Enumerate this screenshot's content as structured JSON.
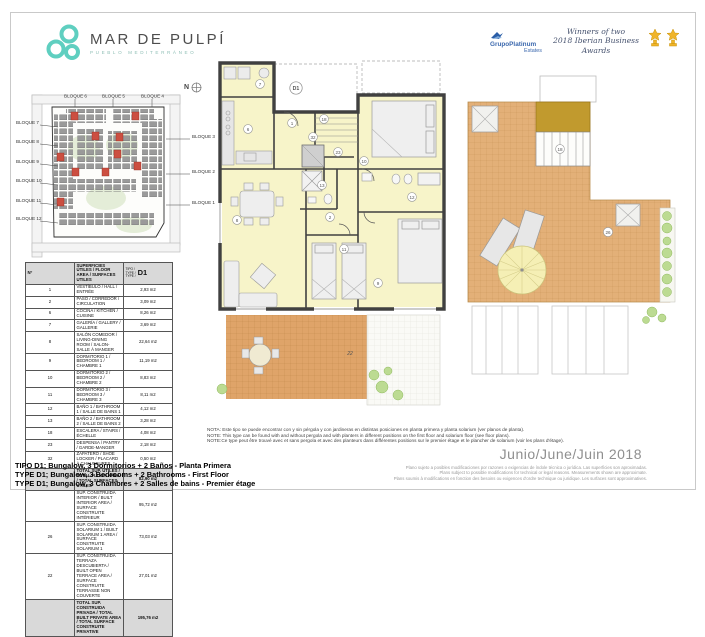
{
  "header": {
    "logo": {
      "title": "MAR DE PULPÍ",
      "subtitle": "PUEBLO MEDITERRÁNEO"
    },
    "awards": {
      "brand_top": "GrupoPlatinum",
      "brand_bottom": "Estates",
      "script_line1": "Winners of two",
      "script_line2": "2018 Iberian Business Awards"
    }
  },
  "site_plan": {
    "north_label": "N",
    "labels_top": [
      "BLOQUE 6",
      "BLOQUE 5",
      "BLOQUE 4"
    ],
    "labels_left": [
      "BLOQUE 7",
      "BLOQUE 8",
      "BLOQUE 9",
      "BLOQUE 10",
      "BLOQUE 11",
      "BLOQUE 12"
    ],
    "labels_right": [
      "BLOQUE 3",
      "BLOQUE 2",
      "BLOQUE 1"
    ]
  },
  "main_plan": {
    "unit_label": "D1",
    "room_numbers": {
      "vestibulo": "1",
      "paso": "2",
      "cocina": "6",
      "galeria": "7",
      "salon": "8",
      "dormitorio1": "9",
      "dormitorio2": "10",
      "dormitorio3": "11",
      "bano1": "12",
      "bano2": "13",
      "escalera": "18",
      "despensa": "23",
      "zapatero": "32",
      "terraza": "22"
    }
  },
  "solarium_plan": {
    "room_numbers": {
      "solarium": "26",
      "escalera": "18"
    }
  },
  "area_table": {
    "header": {
      "num": "Nº",
      "desc": "SUPERFICIES ÚTILES / FLOOR AREA / SURFACES UTILES",
      "type_stack": "TIPO /\nTYPE /\nTYPE /",
      "model": "D1"
    },
    "rows": [
      {
        "num": "1",
        "desc": "VESTÍBULO / HALL / ENTRÉE",
        "value": "2,93 m2"
      },
      {
        "num": "2",
        "desc": "PASO / CORREDOR / CIRCULATION",
        "value": "3,09 m2"
      },
      {
        "num": "6",
        "desc": "COCINA / KITCHEN / CUISINE",
        "value": "8,26 m2"
      },
      {
        "num": "7",
        "desc": "GALERÍA / GALLERY / GALLERIE",
        "value": "3,69 m2"
      },
      {
        "num": "8",
        "desc": "SALÓN COMEDOR / LIVING-DINING ROOM / SALON-SALLE À MANGER",
        "value": "22,64 m2"
      },
      {
        "num": "9",
        "desc": "DORMITORIO 1 / BEDROOM 1 / CHAMBRE 1",
        "value": "11,19 m2"
      },
      {
        "num": "10",
        "desc": "DORMITORIO 2 / BEDROOM 2 / CHAMBRE 2",
        "value": "8,83 m2"
      },
      {
        "num": "11",
        "desc": "DORMITORIO 3 / BEDROOM 3 / CHAMBRE 3",
        "value": "8,11 m2"
      },
      {
        "num": "12",
        "desc": "BAÑO 1 / BATHROOM 1 / SALLE DE BAINS 1",
        "value": "4,12 m2"
      },
      {
        "num": "13",
        "desc": "BAÑO 2 / BATHROOM 2 / SALLE DE BAINS 2",
        "value": "3,28 m2"
      },
      {
        "num": "18",
        "desc": "ESCALERA / STAIRS / ÉCHELLE",
        "value": "4,08 m2"
      },
      {
        "num": "23",
        "desc": "DESPENSA / PANTRY / GARDE-MANGER",
        "value": "2,18 m2"
      },
      {
        "num": "32",
        "desc": "ZAPATERO / SHOE LOCKER / PLACARD À CHAUSSURES",
        "value": "0,50 m2"
      }
    ],
    "summary": [
      {
        "num": "",
        "desc": "TOTAL SUP. ÚTILES / TOTAL FLOOR AREA / TOTAL SURFACES UTILES",
        "value": "82,90 m2",
        "shaded": true
      },
      {
        "num": "",
        "desc": "SUP. CONSTRUIDA INTERIOR / BUILT INTERIOR AREA / SURFACE CONSTRUITE INTÉRIEUR",
        "value": "95,72 m2",
        "shaded": false
      },
      {
        "num": "26",
        "desc": "SUP. CONSTRUIDA SOLARIUM 1 / BUILT SOLARIUM 1 AREA / SURFACE CONSTRUITE SOLARIUM 1",
        "value": "73,03 m2",
        "shaded": false
      },
      {
        "num": "22",
        "desc": "SUP. CONSTRUIDA TERRAZA DESCUBIERTA / BUILT OPEN TERRACE AREA / SURFACE CONSTRUITE TERRASSE NON COUVERTE",
        "value": "27,01 m2",
        "shaded": false
      },
      {
        "num": "",
        "desc": "TOTAL SUP. CONSTRUIDA PRIVADA / TOTAL BUILT PRIVATE AREA / TOTAL SURFACE CONSTRUITE PRIVATIVE",
        "value": "195,76 m2",
        "shaded": true
      }
    ]
  },
  "type_lines": [
    "TIPO D1; Bungalow, 3 Dormitorios + 2 Baños - Planta Primera",
    "TYPE D1; Bungalow, 3 Bedrooms + 2 Bathrooms - First Floor",
    "TYPE D1; Bungalow, 3 Chambres + 2 Salles de bains - Premier étage"
  ],
  "notes": [
    "NOTA: Este tipo se puede encontrar con y sin pérgola y con jardineras en distintas posiciones en planta primera y planta solarium (ver planos de planta).",
    "NOTE: This type can be found with and without pergola and with planters in different positions on the first floor and solarium floor (see floor plans).",
    "NOTE:Ce type peut être trouvé avec et sans pergola et avec des planteurs dans différentes positions sur le premier étage et le plancher de solarium (voir les plans d'étage)."
  ],
  "date": "Junio/June/Juin 2018",
  "disclaimers": [
    "Plano sujeto a posibles modificaciones por razones o exigencias de índole técnica o jurídica. Las superficies son aproximadas.",
    "Plans subject to possible modifications for technical or legal reasons. Measurements shown are approximate.",
    "Plans soumis à modifications en fonction des besoins ou exigences d'ordre technique ou juridique. Les surfaces sont approximatives."
  ],
  "colors": {
    "accent_teal": "#5fcfc0",
    "plan_room": "#f7f4c9",
    "wall": "#404040",
    "terrace_orange": "#dfa469",
    "solarium_tan": "#e3b078",
    "solarium_roof_gold": "#c19a2e",
    "site_highlight_red": "#cc4f41",
    "trophy_gold": "#f0b429"
  }
}
